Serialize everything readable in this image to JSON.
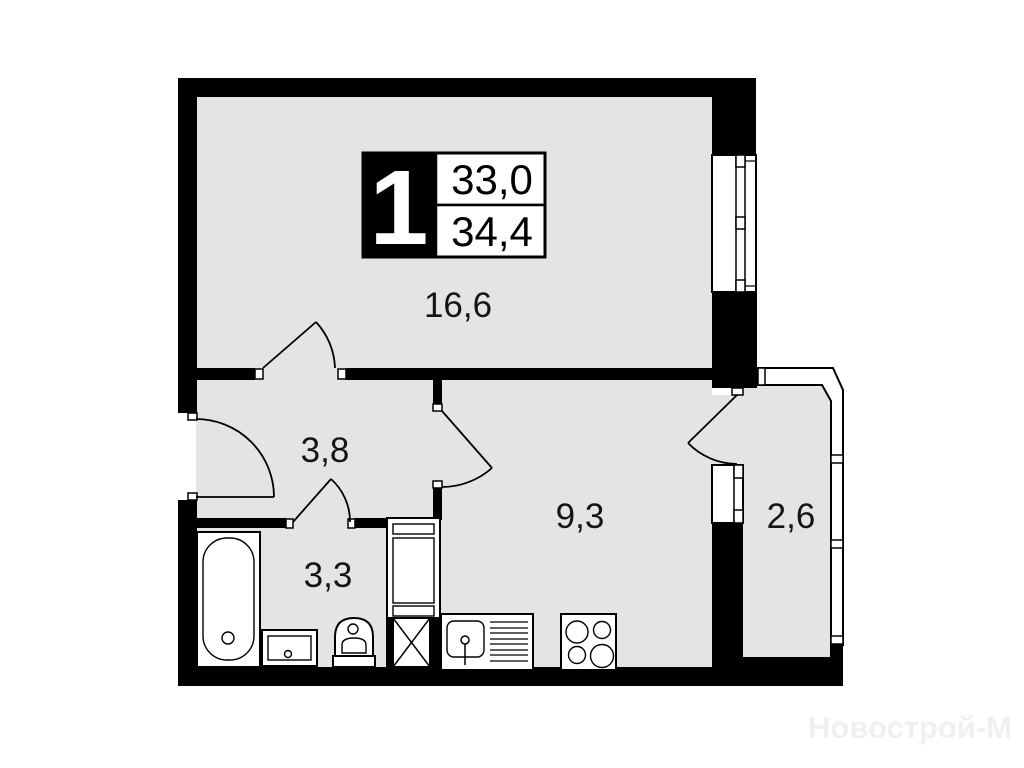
{
  "plan": {
    "badge": {
      "room_count": "1",
      "area_top": "33,0",
      "area_bottom": "34,4"
    },
    "areas": {
      "living": "16,6",
      "hallway": "3,8",
      "bathroom": "3,3",
      "kitchen": "9,3",
      "balcony": "2,6"
    },
    "watermark": "Новострой-М",
    "colors": {
      "floor": "#e4e4e4",
      "wall": "#000000",
      "paper": "#ffffff",
      "watermark": "#f0f0f0"
    }
  }
}
